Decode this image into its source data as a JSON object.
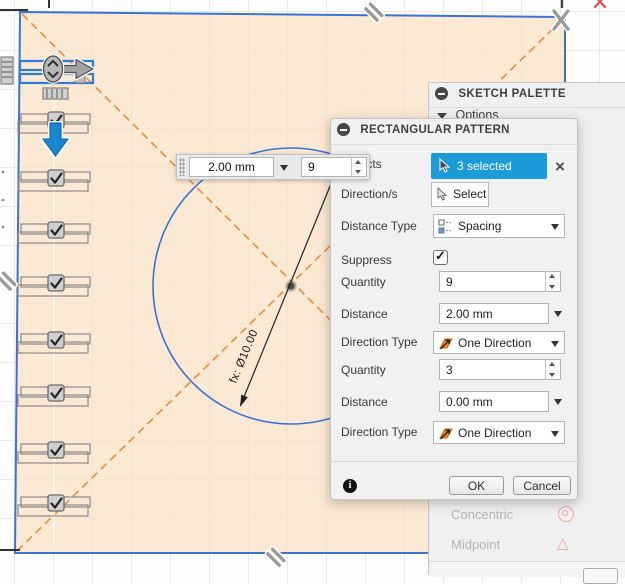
{
  "canvas": {
    "dimension_label": "fx: Ø10.00",
    "instances": [
      112,
      170,
      222,
      275,
      332,
      385,
      442,
      495
    ],
    "instances_checked": true
  },
  "toolbar": {
    "distance_value": "2.00 mm",
    "quantity_value": "9"
  },
  "palette": {
    "title": "SKETCH PALETTE",
    "options_label": "Options",
    "items": [
      {
        "label": "Concentric"
      },
      {
        "label": "Midpoint"
      }
    ]
  },
  "dialog": {
    "title": "RECTANGULAR PATTERN",
    "objects_label": "Objects",
    "objects_value": "3 selected",
    "objects_clear": "×",
    "direction_label": "Direction/s",
    "direction_button": "Select",
    "distance_type_label": "Distance Type",
    "distance_type_value": "Spacing",
    "suppress_label": "Suppress",
    "quantity1_label": "Quantity",
    "quantity1_value": "9",
    "distance1_label": "Distance",
    "distance1_value": "2.00 mm",
    "direction_type1_label": "Direction Type",
    "direction_type1_value": "One Direction",
    "quantity2_label": "Quantity",
    "quantity2_value": "3",
    "distance2_label": "Distance",
    "distance2_value": "0.00 mm",
    "direction_type2_label": "Direction Type",
    "direction_type2_value": "One Direction",
    "info_label": "i",
    "ok_label": "OK",
    "cancel_label": "Cancel"
  },
  "colors": {
    "selection_blue": "#1b9cd8",
    "sketch_blue": "#3a72d6",
    "construction_orange": "#ec8b3f",
    "constraint_pink": "#f0a4a4",
    "profile_fill": "rgba(249,224,193,0.7)"
  }
}
